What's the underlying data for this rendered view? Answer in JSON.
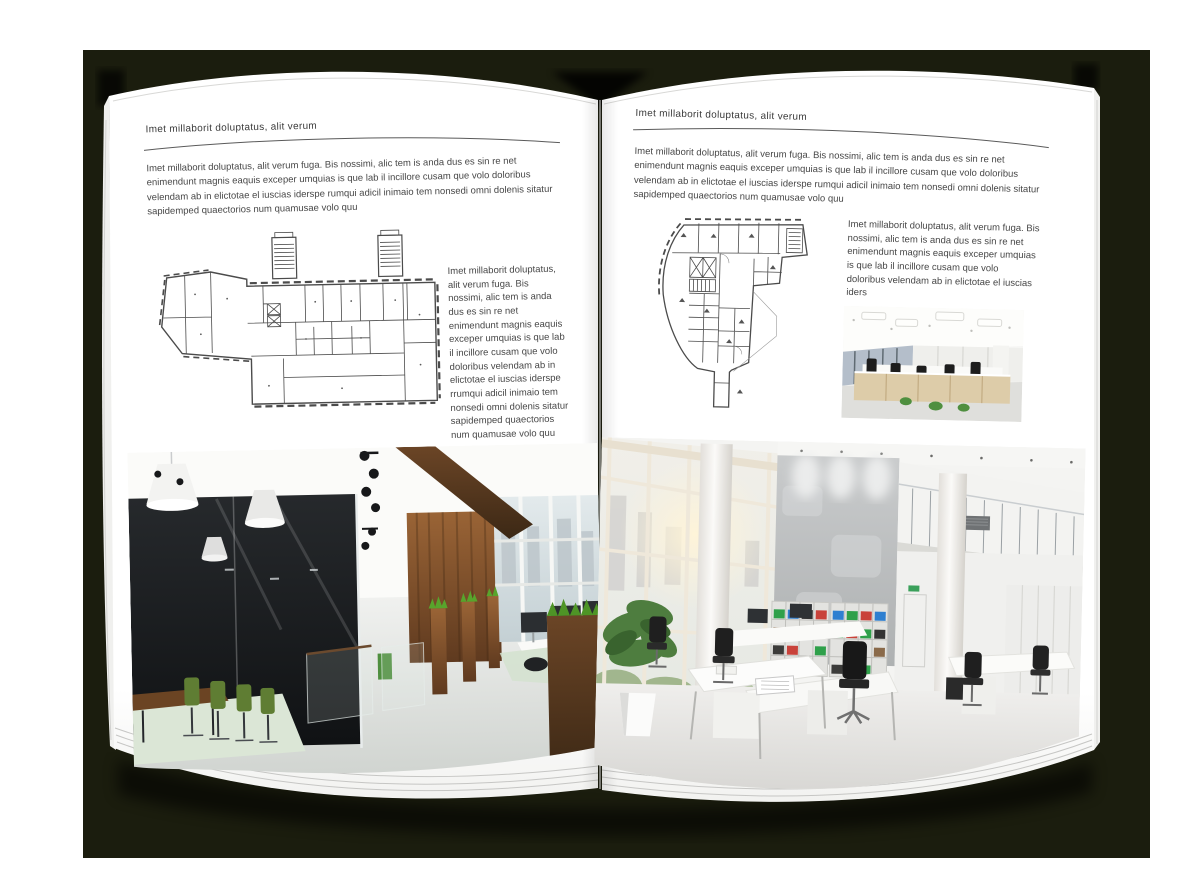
{
  "document": {
    "kind": "magazine-spread-mockup",
    "colors": {
      "backdrop": "#1b1d0e",
      "page": "#ffffff",
      "body_text": "#474747",
      "rule": "#5a5a5a",
      "wood_accent": "#7a4c28",
      "plant_green": "#4f8f3f"
    },
    "page_left": {
      "header": "Imet millaborit doluptatus, alit verum",
      "intro": "Imet millaborit doluptatus, alit verum fuga. Bis nossimi, alic tem is anda dus es sin re net enimendunt magnis eaquis exceper umquias is que lab il incillore cusam que volo doloribus velendam ab in elictotae el iuscias iderspe rumqui adicil inimaio tem nonsedi omni dolenis sitatur sapidemped quaectorios num quamusae volo quu",
      "side_text": "Imet millaborit doluptatus, alit verum fuga. Bis nossimi, alic tem is anda dus es sin re net enimendunt magnis eaquis exceper umquias is que lab il incillore cusam que volo doloribus velendam ab in elictotae el iuscias iderspe rrumqui adicil inimaio tem nonsedi omni dolenis sitatur sapidemped quaectorios num quamusae volo quu",
      "figures": {
        "floorplan": "architectural-floor-plan",
        "photo": "dark-wood-open-office-interior"
      }
    },
    "page_right": {
      "header": "Imet millaborit doluptatus, alit verum",
      "intro": "Imet millaborit doluptatus, alit verum fuga. Bis nossimi, alic tem is anda dus es sin re net enimendunt magnis eaquis exceper umquias is que lab il incillore cusam que volo doloribus velendam ab in elictotae el iuscias iderspe rumqui adicil inimaio tem nonsedi omni dolenis sitatur sapidemped quaectorios num quamusae volo quu",
      "side_text": "Imet millaborit doluptatus, alit verum fuga. Bis nossimi, alic tem is anda dus es sin re net enimendunt magnis eaquis exceper umquias is que lab il incillore cusam que volo doloribus velendam ab in elictotae el iuscias iders",
      "figures": {
        "floorplan": "architectural-floor-plan",
        "photo_small": "white-open-office-interior",
        "photo_large": "atrium-office-interior"
      }
    }
  }
}
